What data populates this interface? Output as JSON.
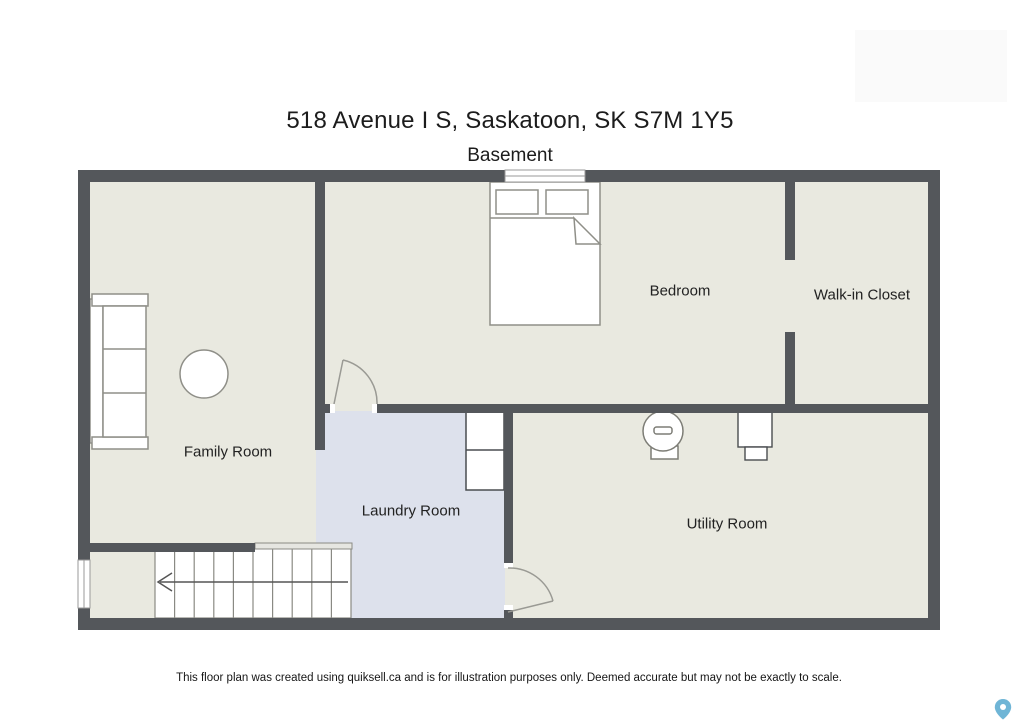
{
  "header": {
    "title": "518 Avenue I S, Saskatoon, SK S7M 1Y5",
    "subtitle": "Basement"
  },
  "floorplan": {
    "rooms": [
      {
        "name": "family-room",
        "label": "Family Room"
      },
      {
        "name": "bedroom",
        "label": "Bedroom"
      },
      {
        "name": "walk-in-closet",
        "label": "Walk-in Closet"
      },
      {
        "name": "laundry-room",
        "label": "Laundry Room"
      },
      {
        "name": "utility-room",
        "label": "Utility Room"
      }
    ],
    "fixtures": [
      "bed",
      "pillows",
      "sofa",
      "coffee-table",
      "staircase",
      "stair-direction-arrow",
      "handrail",
      "washer-dryer-stack",
      "water-heater",
      "furnace",
      "interior-doors",
      "windows"
    ],
    "colors": {
      "wall": "#54575b",
      "floor": "#e9e9e0",
      "laundry_floor": "#dde1ec",
      "fixture_stroke": "#8f8f88",
      "pin_blue": "#6fb5d6"
    }
  },
  "footer": {
    "disclaimer": "This floor plan was created using quiksell.ca and is for illustration purposes only. Deemed accurate but may not be exactly to scale.",
    "map_pin_icon": "map-pin"
  }
}
